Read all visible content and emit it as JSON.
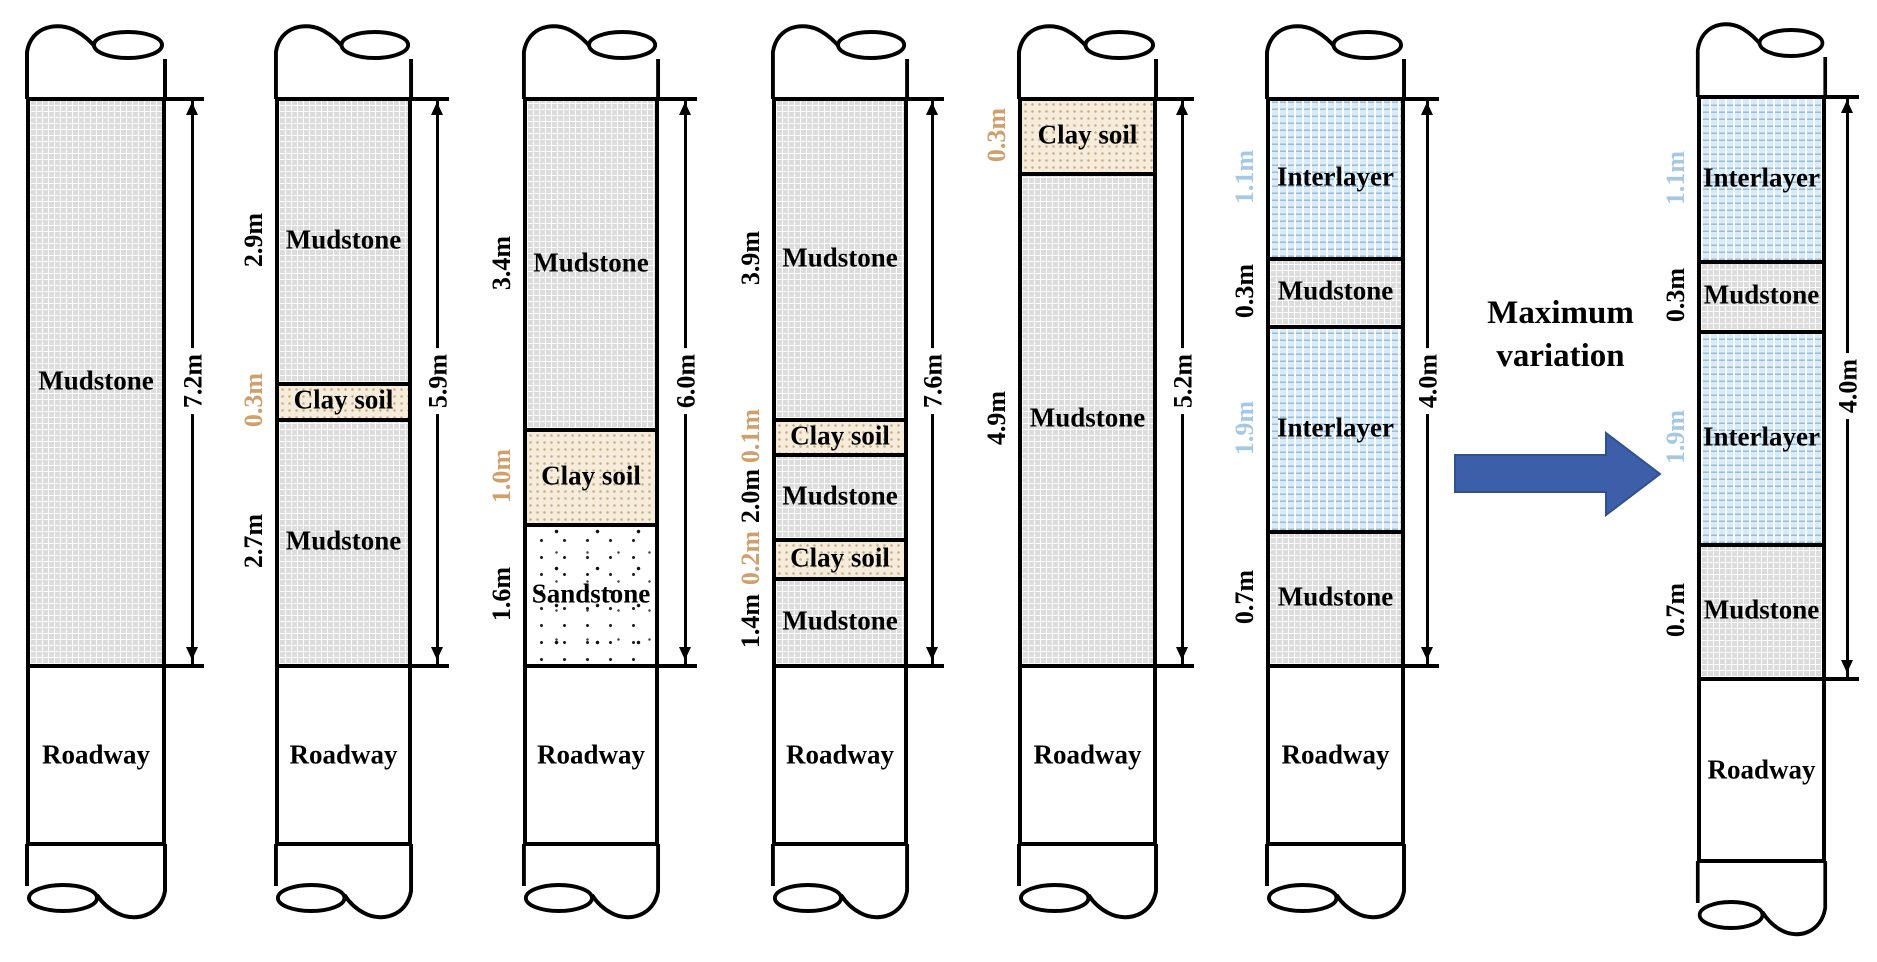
{
  "canvas": {
    "width": 1877,
    "height": 962,
    "background": "#ffffff"
  },
  "colors": {
    "line": "#000000",
    "mudstone_bg": "#dcdcdc",
    "clay_bg": "#f6ecdb",
    "clay_dot": "#c9ab85",
    "sandstone_bg": "#ffffff",
    "interlayer_bg": "#daeaf6",
    "interlayer_line": "#97bed9",
    "clay_label": "#cfa06b",
    "interlayer_label": "#a6c8e2",
    "black_label": "#000000",
    "arrow_fill": "#3d5fa9",
    "arrow_stroke": "#31508f"
  },
  "annotation": {
    "line1": "Maximum",
    "line2": "variation"
  },
  "columns": [
    {
      "name": "column-1",
      "x": 26,
      "width": 140,
      "strata_top": 97,
      "strata_bottom": 664,
      "roadway_bottom": 846,
      "dim_x": 192,
      "dim_label": "7.2m",
      "roadway_label": "Roadway",
      "layers": [
        {
          "material": "mudstone",
          "label": "Mudstone",
          "top": 97,
          "bottom": 664,
          "thickness": null,
          "thickness_color": "black_label"
        }
      ]
    },
    {
      "name": "column-2",
      "x": 275,
      "width": 137,
      "strata_top": 97,
      "strata_bottom": 664,
      "roadway_bottom": 846,
      "dim_x": 437,
      "dim_label": "5.9m",
      "roadway_label": "Roadway",
      "layers": [
        {
          "material": "mudstone",
          "label": "Mudstone",
          "top": 97,
          "bottom": 382,
          "thickness": "2.9m",
          "thickness_color": "black_label"
        },
        {
          "material": "clay",
          "label": "Clay soil",
          "top": 382,
          "bottom": 418,
          "thickness": "0.3m",
          "thickness_color": "clay_label"
        },
        {
          "material": "mudstone",
          "label": "Mudstone",
          "top": 418,
          "bottom": 664,
          "thickness": "2.7m",
          "thickness_color": "black_label"
        }
      ]
    },
    {
      "name": "column-3",
      "x": 523,
      "width": 136,
      "strata_top": 97,
      "strata_bottom": 664,
      "roadway_bottom": 846,
      "dim_x": 685,
      "dim_label": "6.0m",
      "roadway_label": "Roadway",
      "layers": [
        {
          "material": "mudstone",
          "label": "Mudstone",
          "top": 97,
          "bottom": 428,
          "thickness": "3.4m",
          "thickness_color": "black_label"
        },
        {
          "material": "clay",
          "label": "Clay soil",
          "top": 428,
          "bottom": 523,
          "thickness": "1.0m",
          "thickness_color": "clay_label"
        },
        {
          "material": "sandstone",
          "label": "Sandstone",
          "top": 523,
          "bottom": 664,
          "thickness": "1.6m",
          "thickness_color": "black_label"
        }
      ]
    },
    {
      "name": "column-4",
      "x": 772,
      "width": 136,
      "strata_top": 97,
      "strata_bottom": 664,
      "roadway_bottom": 846,
      "dim_x": 932,
      "dim_label": "7.6m",
      "roadway_label": "Roadway",
      "layers": [
        {
          "material": "mudstone",
          "label": "Mudstone",
          "top": 97,
          "bottom": 418,
          "thickness": "3.9m",
          "thickness_color": "black_label"
        },
        {
          "material": "clay",
          "label": "Clay soil",
          "top": 418,
          "bottom": 453,
          "thickness": "0.1m",
          "thickness_color": "clay_label"
        },
        {
          "material": "mudstone",
          "label": "Mudstone",
          "top": 453,
          "bottom": 538,
          "thickness": "2.0m",
          "thickness_color": "black_label"
        },
        {
          "material": "clay",
          "label": "Clay soil",
          "top": 538,
          "bottom": 577,
          "thickness": "0.2m",
          "thickness_color": "clay_label"
        },
        {
          "material": "mudstone",
          "label": "Mudstone",
          "top": 577,
          "bottom": 664,
          "thickness": "1.4m",
          "thickness_color": "black_label"
        }
      ]
    },
    {
      "name": "column-5",
      "x": 1018,
      "width": 139,
      "strata_top": 97,
      "strata_bottom": 664,
      "roadway_bottom": 846,
      "dim_x": 1182,
      "dim_label": "5.2m",
      "roadway_label": "Roadway",
      "layers": [
        {
          "material": "clay",
          "label": "Clay soil",
          "top": 97,
          "bottom": 172,
          "thickness": "0.3m",
          "thickness_color": "clay_label"
        },
        {
          "material": "mudstone",
          "label": "Mudstone",
          "top": 172,
          "bottom": 664,
          "thickness": "4.9m",
          "thickness_color": "black_label"
        }
      ]
    },
    {
      "name": "column-6",
      "x": 1266,
      "width": 139,
      "strata_top": 97,
      "strata_bottom": 664,
      "roadway_bottom": 846,
      "dim_x": 1427,
      "dim_label": "4.0m",
      "roadway_label": "Roadway",
      "layers": [
        {
          "material": "interlayer",
          "label": "Interlayer",
          "top": 97,
          "bottom": 257,
          "thickness": "1.1m",
          "thickness_color": "interlayer_label"
        },
        {
          "material": "mudstone",
          "label": "Mudstone",
          "top": 257,
          "bottom": 325,
          "thickness": "0.3m",
          "thickness_color": "black_label"
        },
        {
          "material": "interlayer",
          "label": "Interlayer",
          "top": 325,
          "bottom": 530,
          "thickness": "1.9m",
          "thickness_color": "interlayer_label"
        },
        {
          "material": "mudstone",
          "label": "Mudstone",
          "top": 530,
          "bottom": 664,
          "thickness": "0.7m",
          "thickness_color": "black_label"
        }
      ]
    },
    {
      "name": "column-7",
      "x": 1697,
      "width": 129,
      "strata_top": 95,
      "strata_bottom": 677,
      "roadway_bottom": 863,
      "dim_x": 1847,
      "dim_label": "4.0m",
      "roadway_label": "Roadway",
      "layers": [
        {
          "material": "interlayer",
          "label": "Interlayer",
          "top": 95,
          "bottom": 260,
          "thickness": "1.1m",
          "thickness_color": "interlayer_label"
        },
        {
          "material": "mudstone",
          "label": "Mudstone",
          "top": 260,
          "bottom": 330,
          "thickness": "0.3m",
          "thickness_color": "black_label"
        },
        {
          "material": "interlayer",
          "label": "Interlayer",
          "top": 330,
          "bottom": 543,
          "thickness": "1.9m",
          "thickness_color": "interlayer_label"
        },
        {
          "material": "mudstone",
          "label": "Mudstone",
          "top": 543,
          "bottom": 677,
          "thickness": "0.7m",
          "thickness_color": "black_label"
        }
      ]
    }
  ]
}
